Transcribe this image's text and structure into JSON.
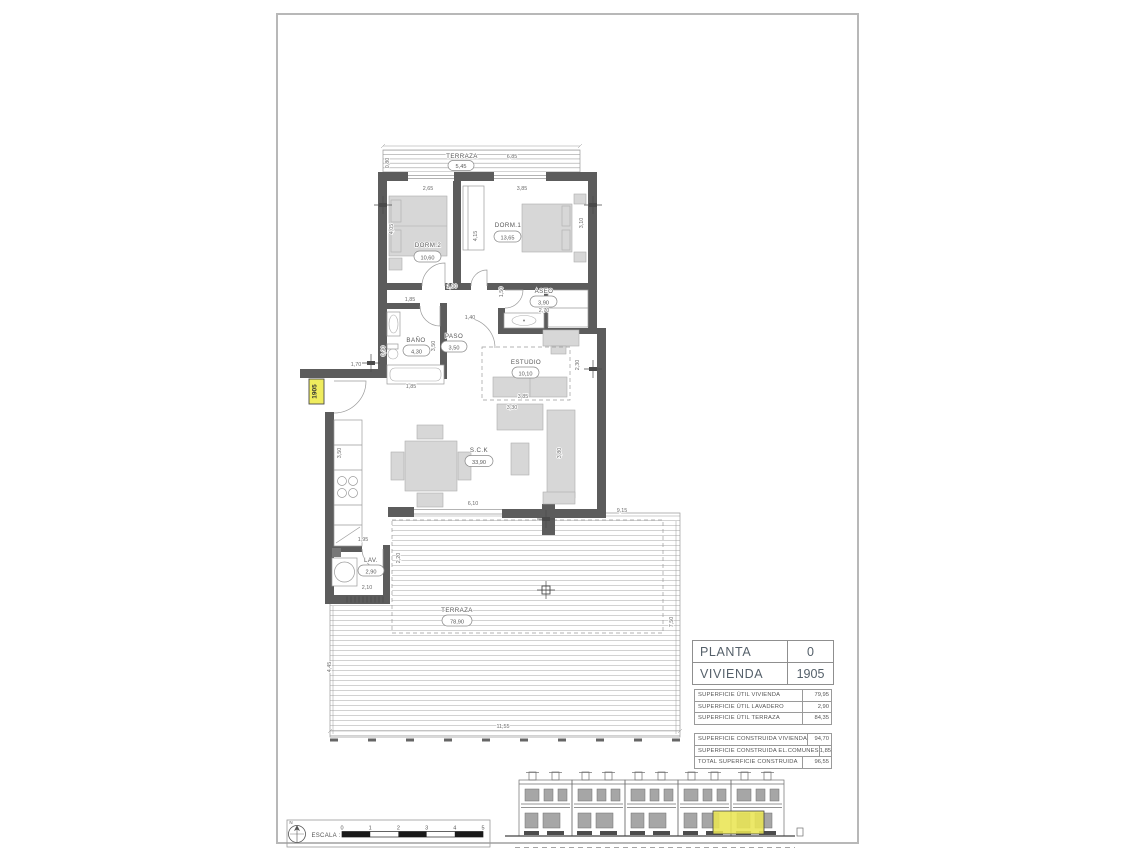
{
  "title_block": {
    "main": [
      {
        "label": "PLANTA",
        "value": "0"
      },
      {
        "label": "VIVIENDA",
        "value": "1905"
      }
    ],
    "util": [
      {
        "label": "SUPERFICIE ÚTIL VIVIENDA",
        "value": "79,95"
      },
      {
        "label": "SUPERFICIE ÚTIL LAVADERO",
        "value": "2,90"
      },
      {
        "label": "SUPERFICIE ÚTIL TERRAZA",
        "value": "84,35"
      }
    ],
    "construida": [
      {
        "label": "SUPERFICIE CONSTRUIDA VIVIENDA",
        "value": "94,70"
      },
      {
        "label": "SUPERFICIE CONSTRUIDA EL.COMUNES",
        "value": "1,85"
      },
      {
        "label": "TOTAL SUPERFICIE CONSTRUIDA",
        "value": "96,55"
      }
    ]
  },
  "scale_bar": {
    "label": "ESCALA :",
    "ticks": [
      "0",
      "1",
      "2",
      "3",
      "4",
      "5"
    ],
    "north_label": "N"
  },
  "plan": {
    "unit_tag": "1905",
    "rooms": [
      {
        "name": "TERRAZA",
        "area": "5,45"
      },
      {
        "name": "DORM.2",
        "area": "10,60"
      },
      {
        "name": "DORM.1",
        "area": "13,65"
      },
      {
        "name": "ASEO",
        "area": "3,90"
      },
      {
        "name": "BAÑO",
        "area": "4,30"
      },
      {
        "name": "PASO",
        "area": "3,50"
      },
      {
        "name": "ESTUDIO",
        "area": "10,10"
      },
      {
        "name": "S.C.K",
        "area": "33,90"
      },
      {
        "name": "LAV.",
        "area": "2,90"
      },
      {
        "name": "TERRAZA",
        "area": "78,90"
      }
    ],
    "dims": [
      "6,85",
      "0,80",
      "2,65",
      "3,85",
      "4,05",
      "4,15",
      "3,10",
      "1,85",
      "1,00",
      "1,50",
      "2,70",
      "0,90",
      "3,50",
      "1,40",
      "1,85",
      "3,85",
      "3,30",
      "2,30",
      "3,80",
      "3,50",
      "6,10",
      "1,95",
      "2,10",
      "2,20",
      "9,15",
      "7,50",
      "4,45",
      "11,55",
      "1,70"
    ]
  },
  "colors": {
    "wall": "#5c5c5c",
    "highlight_yellow": "#e9e554",
    "sheet_border": "#b8b8b8"
  }
}
